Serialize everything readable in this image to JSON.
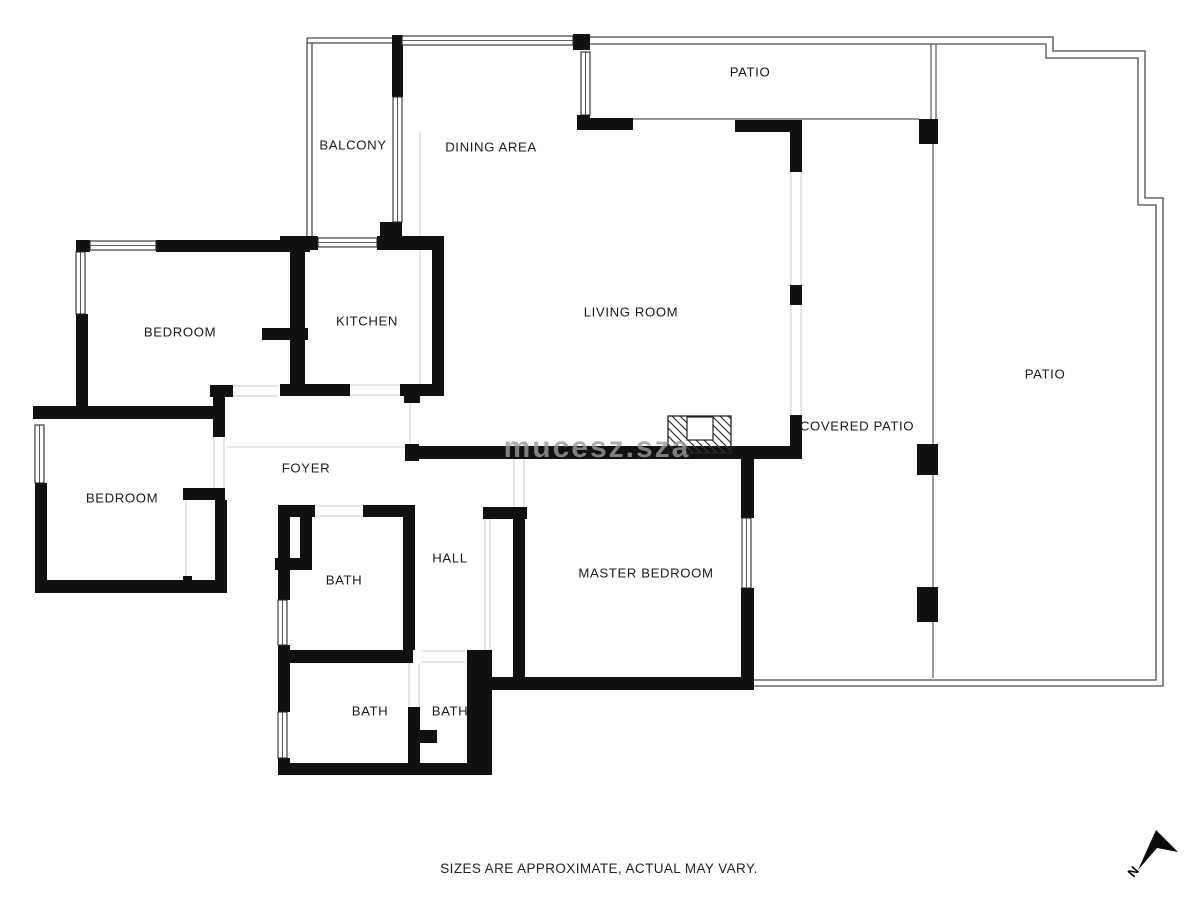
{
  "meta": {
    "footer": "SIZES ARE APPROXIMATE, ACTUAL MAY VARY.",
    "watermark": "mucesz.sza"
  },
  "colors": {
    "wall": "#111111",
    "label": "#1b1b1b",
    "thin": "#5a5a5a",
    "outline": "#4a4a4a",
    "light": "#d6d6d6",
    "watermark": "#9a9a9a",
    "window_stroke": "#2a2a2a"
  },
  "rooms": [
    {
      "name": "PATIO",
      "x": 750,
      "y": 72
    },
    {
      "name": "BALCONY",
      "x": 353,
      "y": 145
    },
    {
      "name": "DINING AREA",
      "x": 491,
      "y": 147
    },
    {
      "name": "BEDROOM",
      "x": 180,
      "y": 332
    },
    {
      "name": "KITCHEN",
      "x": 367,
      "y": 321
    },
    {
      "name": "LIVING ROOM",
      "x": 631,
      "y": 312
    },
    {
      "name": "PATIO",
      "x": 1045,
      "y": 374
    },
    {
      "name": "BEDROOM",
      "x": 122,
      "y": 498
    },
    {
      "name": "FOYER",
      "x": 306,
      "y": 468
    },
    {
      "name": "COVERED PATIO",
      "x": 857,
      "y": 426
    },
    {
      "name": "HALL",
      "x": 450,
      "y": 558
    },
    {
      "name": "BATH",
      "x": 344,
      "y": 580
    },
    {
      "name": "MASTER BEDROOM",
      "x": 646,
      "y": 573
    },
    {
      "name": "BATH",
      "x": 370,
      "y": 711
    },
    {
      "name": "BATH",
      "x": 450,
      "y": 711
    }
  ],
  "floorplan": {
    "walls": [
      [
        76,
        240,
        14,
        12
      ],
      [
        156,
        240,
        154,
        12
      ],
      [
        76,
        314,
        12,
        98
      ],
      [
        33,
        406,
        190,
        13
      ],
      [
        392,
        35,
        11,
        62
      ],
      [
        380,
        222,
        22,
        18
      ],
      [
        280,
        236,
        38,
        14
      ],
      [
        377,
        236,
        67,
        14
      ],
      [
        290,
        248,
        15,
        80
      ],
      [
        262,
        328,
        46,
        12
      ],
      [
        290,
        340,
        15,
        48
      ],
      [
        432,
        236,
        12,
        160
      ],
      [
        280,
        384,
        70,
        12
      ],
      [
        210,
        385,
        23,
        12
      ],
      [
        213,
        386,
        12,
        51
      ],
      [
        400,
        384,
        44,
        12
      ],
      [
        404,
        396,
        16,
        7
      ],
      [
        573,
        34,
        17,
        16
      ],
      [
        577,
        115,
        13,
        15
      ],
      [
        590,
        118,
        43,
        12
      ],
      [
        735,
        120,
        67,
        12
      ],
      [
        790,
        120,
        12,
        52
      ],
      [
        790,
        285,
        12,
        20
      ],
      [
        790,
        415,
        12,
        44
      ],
      [
        405,
        444,
        14,
        17
      ],
      [
        405,
        446,
        397,
        13
      ],
      [
        919,
        119,
        19,
        25
      ],
      [
        917,
        444,
        21,
        31
      ],
      [
        917,
        587,
        21,
        35
      ],
      [
        741,
        448,
        13,
        70
      ],
      [
        741,
        588,
        13,
        102
      ],
      [
        483,
        507,
        44,
        12
      ],
      [
        513,
        512,
        12,
        178
      ],
      [
        488,
        677,
        265,
        13
      ],
      [
        35,
        483,
        12,
        110
      ],
      [
        35,
        580,
        192,
        13
      ],
      [
        183,
        488,
        42,
        12
      ],
      [
        215,
        500,
        12,
        92
      ],
      [
        183,
        576,
        9,
        12
      ],
      [
        278,
        505,
        37,
        12
      ],
      [
        363,
        505,
        47,
        12
      ],
      [
        278,
        517,
        12,
        50
      ],
      [
        300,
        517,
        12,
        42
      ],
      [
        275,
        558,
        37,
        12
      ],
      [
        278,
        570,
        12,
        30
      ],
      [
        278,
        645,
        12,
        18
      ],
      [
        403,
        505,
        12,
        145
      ],
      [
        278,
        650,
        135,
        13
      ],
      [
        278,
        663,
        12,
        49
      ],
      [
        278,
        758,
        12,
        17
      ],
      [
        278,
        763,
        214,
        12
      ],
      [
        408,
        707,
        12,
        68
      ],
      [
        408,
        730,
        29,
        13
      ],
      [
        467,
        650,
        25,
        125
      ],
      [
        468,
        650,
        22,
        13
      ]
    ],
    "windows": [
      [
        90,
        241,
        66,
        9
      ],
      [
        76,
        252,
        9,
        62
      ],
      [
        318,
        238,
        59,
        9
      ],
      [
        393,
        97,
        9,
        125
      ],
      [
        402,
        36,
        171,
        9
      ],
      [
        581,
        52,
        9,
        63
      ],
      [
        35,
        425,
        9,
        58
      ],
      [
        278,
        600,
        9,
        45
      ],
      [
        278,
        712,
        9,
        46
      ],
      [
        742,
        518,
        9,
        70
      ]
    ],
    "outline_paths": [
      "M582,37 H1053 V51 H1145 V198 H1163 V686 H754",
      "M582,44 H1046 V58 H1138 V205 H1156 V680 H754",
      "M307,38 H392",
      "M307,43 H392",
      "M307,38 V236",
      "M312,43 V236"
    ],
    "thin_lines": [
      [
        633,
        119,
        919,
        119
      ],
      [
        931,
        44,
        931,
        119
      ],
      [
        936,
        44,
        936,
        119
      ],
      [
        933,
        143,
        933,
        444
      ],
      [
        933,
        475,
        933,
        587
      ],
      [
        933,
        622,
        933,
        678
      ]
    ],
    "light_lines": [
      [
        420,
        132,
        420,
        384
      ],
      [
        410,
        396,
        410,
        446
      ],
      [
        227,
        447,
        405,
        447
      ],
      [
        186,
        500,
        186,
        576
      ],
      [
        485,
        519,
        485,
        650
      ],
      [
        490,
        519,
        490,
        650
      ],
      [
        350,
        385,
        400,
        385
      ],
      [
        350,
        395,
        400,
        395
      ],
      [
        233,
        386,
        278,
        386
      ],
      [
        233,
        396,
        278,
        396
      ],
      [
        214,
        437,
        214,
        488
      ],
      [
        224,
        437,
        224,
        488
      ],
      [
        514,
        459,
        514,
        512
      ],
      [
        524,
        459,
        524,
        512
      ],
      [
        791,
        172,
        791,
        285
      ],
      [
        801,
        172,
        801,
        285
      ],
      [
        791,
        305,
        791,
        415
      ],
      [
        801,
        305,
        801,
        415
      ],
      [
        421,
        651,
        465,
        651
      ],
      [
        421,
        662,
        465,
        662
      ],
      [
        409,
        663,
        409,
        707
      ],
      [
        419,
        663,
        419,
        707
      ],
      [
        316,
        506,
        362,
        506
      ],
      [
        316,
        516,
        362,
        516
      ]
    ],
    "fireplace": {
      "x": 668,
      "y": 416,
      "w": 63,
      "h": 37,
      "box": {
        "x": 687,
        "y": 417,
        "w": 26,
        "h": 23
      }
    },
    "north": {
      "points": "1156,830 1178,852 1157,848 1138,870",
      "label": "N",
      "lx": 1128,
      "ly": 878,
      "rot": -50
    }
  }
}
